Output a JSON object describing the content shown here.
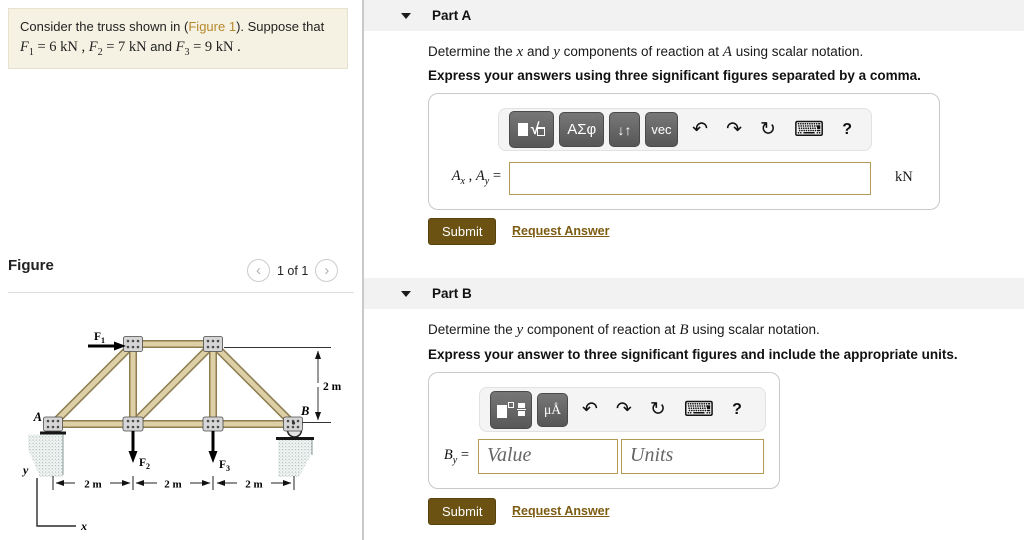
{
  "statement": {
    "pre": "Consider the truss shown in (",
    "link": "Figure 1",
    "post": "). Suppose that",
    "g1_sym": "F",
    "g1_sub": "1",
    "g1_val": " = 6  kN",
    "sep1": " , ",
    "g2_sym": "F",
    "g2_sub": "2",
    "g2_val": " = 7  kN",
    "sep2": " and ",
    "g3_sym": "F",
    "g3_sub": "3",
    "g3_val": " = 9  kN",
    "end": " ."
  },
  "figure_panel": {
    "title": "Figure",
    "nav": {
      "prev": "‹",
      "count": "1 of 1",
      "next": "›"
    }
  },
  "figure": {
    "labels": {
      "a": "A",
      "b": "B",
      "x": "x",
      "y": "y"
    },
    "forces": {
      "f1": {
        "sym": "F",
        "sub": "1"
      },
      "f2": {
        "sym": "F",
        "sub": "2"
      },
      "f3": {
        "sym": "F",
        "sub": "3"
      }
    },
    "dims": {
      "d1": "2 m",
      "d2": "2 m",
      "d3": "2 m",
      "height": "2 m"
    }
  },
  "part_a": {
    "title": "Part A",
    "prompt": {
      "t1": "Determine the ",
      "v1": "x",
      "t2": " and ",
      "v2": "y",
      "t3": " components of reaction at ",
      "v3": "A",
      "t4": " using scalar notation."
    },
    "instruction": "Express your answers using three significant figures separated by a comma.",
    "toolbar": {
      "greek": "ΑΣφ",
      "arrows": "↓↑",
      "vec": "vec",
      "undo": "↶",
      "redo": "↷",
      "reset": "↻",
      "keyboard": "⌨",
      "help": "?"
    },
    "answer_label": {
      "s1": "A",
      "b1": "x",
      "c": " , ",
      "s2": "A",
      "b2": "y",
      "eq": " = "
    },
    "unit": "kN",
    "submit": "Submit",
    "request_answer": "Request Answer"
  },
  "part_b": {
    "title": "Part B",
    "prompt": {
      "t1": "Determine the ",
      "v1": "y",
      "t2": " component of reaction at ",
      "v2": "B",
      "t3": " using scalar notation."
    },
    "instruction": "Express your answer to three significant figures and include the appropriate units.",
    "toolbar": {
      "units_btn": "μÅ",
      "undo": "↶",
      "redo": "↷",
      "reset": "↻",
      "keyboard": "⌨",
      "help": "?"
    },
    "answer_label": {
      "s": "B",
      "b": "y",
      "eq": " = "
    },
    "value_placeholder": "Value",
    "units_placeholder": "Units",
    "submit": "Submit",
    "request_answer": "Request Answer"
  },
  "colors": {
    "statement_bg": "#f5f2e3",
    "figure_link": "#b5892e",
    "section_header_bg": "#f2f2f2",
    "submit_bg": "#6b5213",
    "request_link": "#7d5c12",
    "input_border": "#b49a55",
    "truss_member_fill": "#ddcfa6",
    "truss_member_stroke": "#8d7c50",
    "pedestal_stipple": "#93a8a4"
  }
}
